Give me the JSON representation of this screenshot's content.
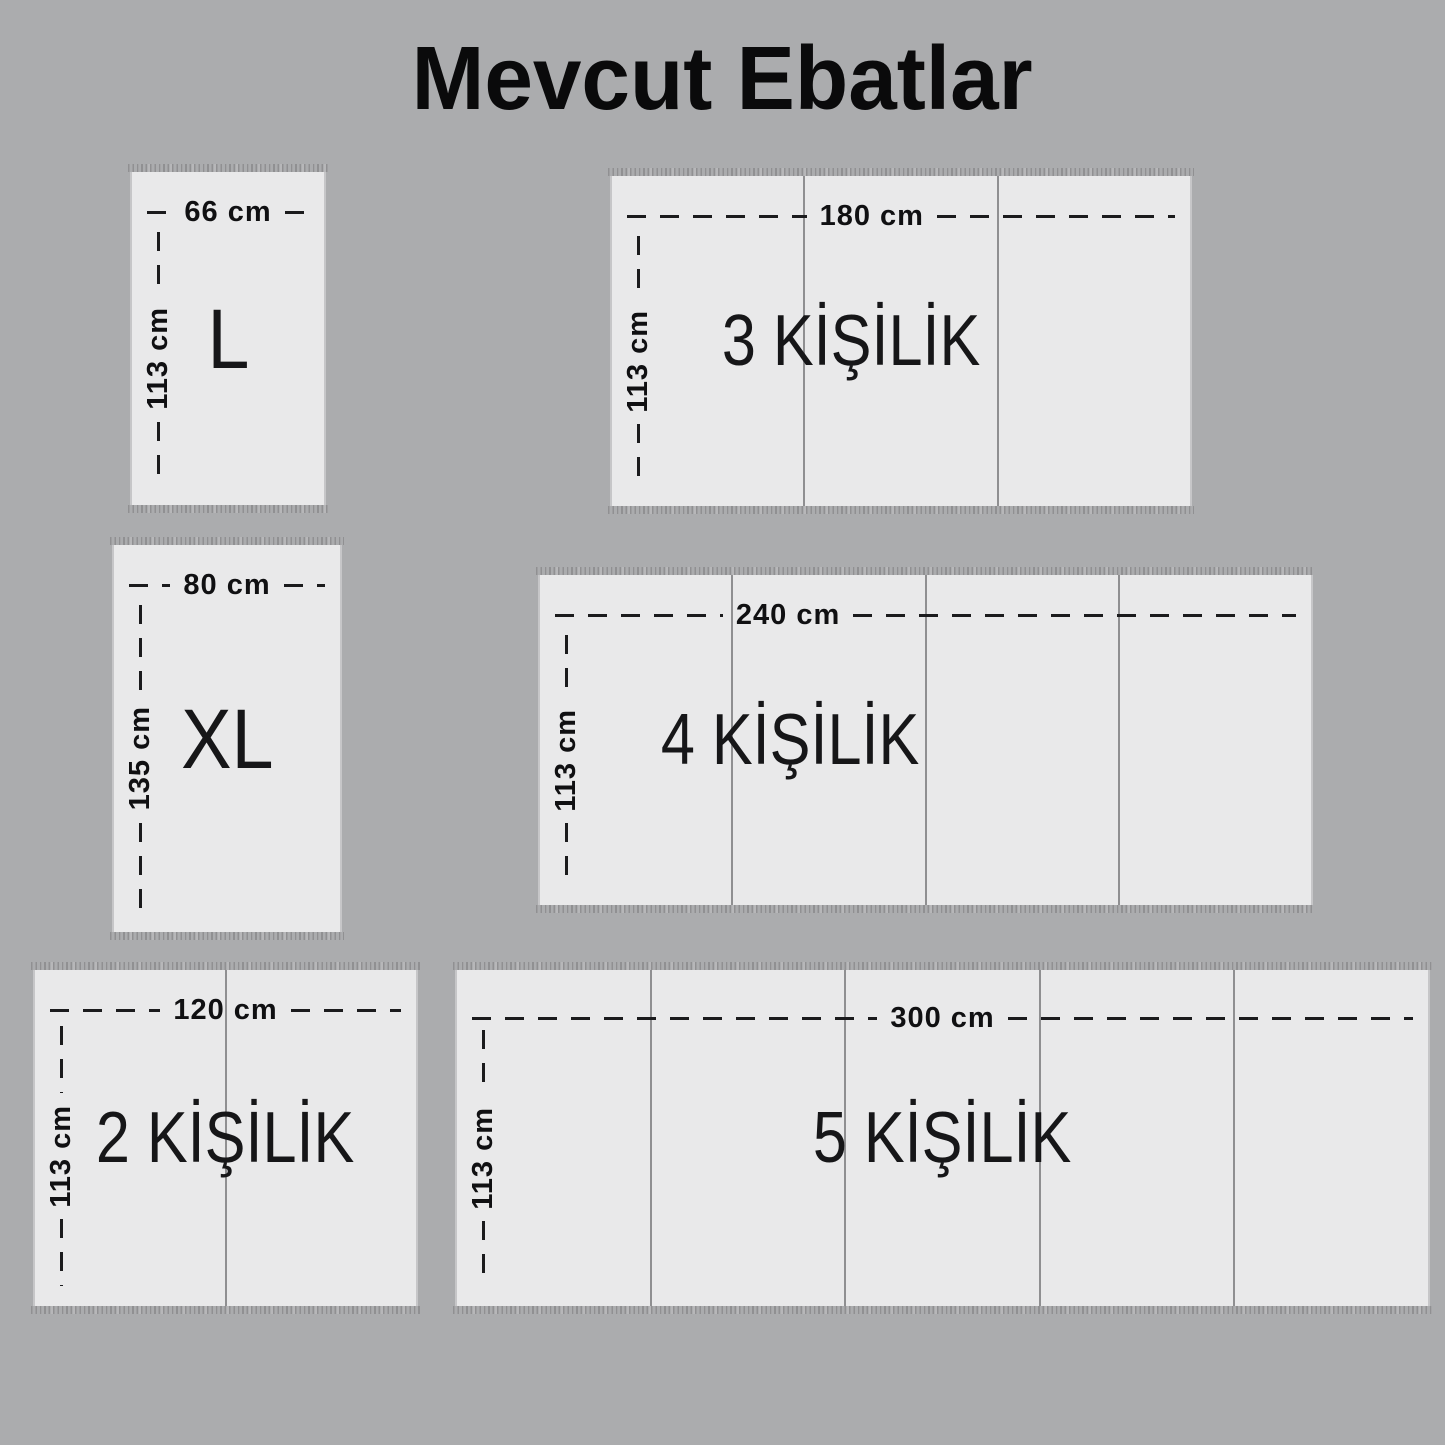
{
  "title": "Mevcut Ebatlar",
  "panels": [
    {
      "id": "L",
      "size_label": "L",
      "width_label": "66 cm",
      "height_label": "113 cm",
      "segments": 1
    },
    {
      "id": "3K",
      "size_label": "3 KİŞİLİK",
      "width_label": "180 cm",
      "height_label": "113 cm",
      "segments": 3
    },
    {
      "id": "XL",
      "size_label": "XL",
      "width_label": "80 cm",
      "height_label": "135 cm",
      "segments": 1
    },
    {
      "id": "4K",
      "size_label": "4 KİŞİLİK",
      "width_label": "240 cm",
      "height_label": "113 cm",
      "segments": 4
    },
    {
      "id": "2K",
      "size_label": "2 KİŞİLİK",
      "width_label": "120 cm",
      "height_label": "113 cm",
      "segments": 2
    },
    {
      "id": "5K",
      "size_label": "5 KİŞİLİK",
      "width_label": "300 cm",
      "height_label": "113 cm",
      "segments": 5
    }
  ],
  "colors": {
    "background": "#abacae",
    "panel": "#e9e9ea",
    "dash": "#1b1b1d",
    "divider": "#8f8f91",
    "fringe": "#8e8e90",
    "text": "#111113"
  }
}
